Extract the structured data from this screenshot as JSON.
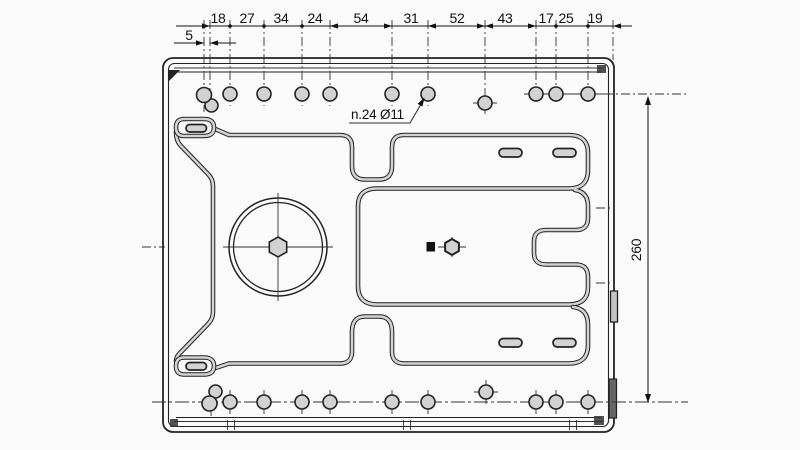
{
  "drawing": {
    "dim_left_offset": "5",
    "dim_chain": [
      "18",
      "27",
      "34",
      "24",
      "54",
      "31",
      "52",
      "43",
      "17",
      "25",
      "19"
    ],
    "hole_note": "n.24 Ø11",
    "dim_height": "260"
  },
  "style": {
    "plate_color": "#d2d2d2",
    "line_color": "#222222",
    "background": "#fafafa"
  }
}
